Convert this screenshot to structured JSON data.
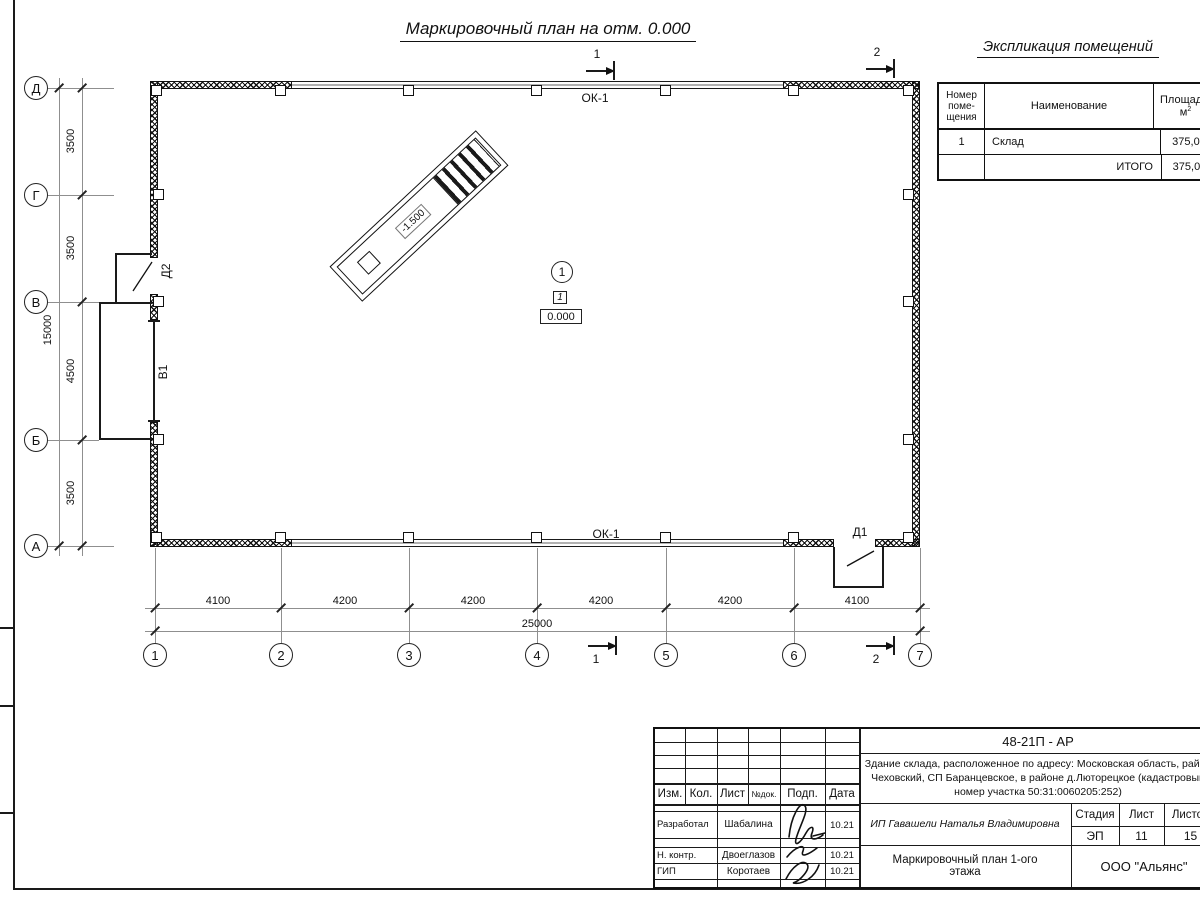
{
  "title": "Маркировочный план на отм. 0.000",
  "explication": {
    "title": "Экспликация  помещений",
    "col_number_l1": "Номер",
    "col_number_l2": "поме-",
    "col_number_l3": "щения",
    "col_name": "Наименование",
    "col_area": "Площадь,",
    "col_area_unit": "м",
    "col_area_sup": "2",
    "row_num": "1",
    "row_name": "Склад",
    "row_area": "375,00",
    "total_label": "ИТОГО",
    "total_value": "375,00"
  },
  "axes": {
    "rows": [
      "Д",
      "Г",
      "В",
      "Б",
      "А"
    ],
    "cols": [
      "1",
      "2",
      "3",
      "4",
      "5",
      "6",
      "7"
    ]
  },
  "dims": {
    "left": [
      "3500",
      "3500",
      "4500",
      "3500"
    ],
    "left_total": "15000",
    "bottom": [
      "4100",
      "4200",
      "4200",
      "4200",
      "4200",
      "4100"
    ],
    "bottom_total": "25000"
  },
  "plan": {
    "ok1_top": "ОК-1",
    "ok1_bottom": "ОК-1",
    "d1": "Д1",
    "d2": "Д2",
    "v1": "В1",
    "ramp_level": "-1.500",
    "room_circle": "1",
    "room_ref": "1",
    "room_level": "0.000",
    "sec1": "1",
    "sec2": "2"
  },
  "titleblock": {
    "code": "48-21П - АР",
    "desc1": "Здание склада, расположенное по адресу: Московская область, район",
    "desc2": "Чеховский, СП Баранцевское, в районе д.Люторецкое  (кадастровый",
    "desc3": "номер участка 50:31:0060205:252)",
    "h_izm": "Изм.",
    "h_kol": "Кол.",
    "h_list": "Лист",
    "h_ndok": "№док.",
    "h_podp": "Подп.",
    "h_data": "Дата",
    "r1_role": "Разработал",
    "r1_name": "Шабалина",
    "r1_date": "10.21",
    "r2_role": "Н. контр.",
    "r2_name": "Двоеглазов",
    "r2_date": "10.21",
    "r3_role": "ГИП",
    "r3_name": "Коротаев",
    "r3_date": "10.21",
    "client": "ИП Гавашели Наталья Владимировна",
    "stage_label": "Стадия",
    "sheet_label": "Лист",
    "sheets_label": "Листов",
    "stage": "ЭП",
    "sheet": "11",
    "sheets": "15",
    "drawing": "Маркировочный план 1-ого этажа",
    "company": "ООО \"Альянс\""
  }
}
